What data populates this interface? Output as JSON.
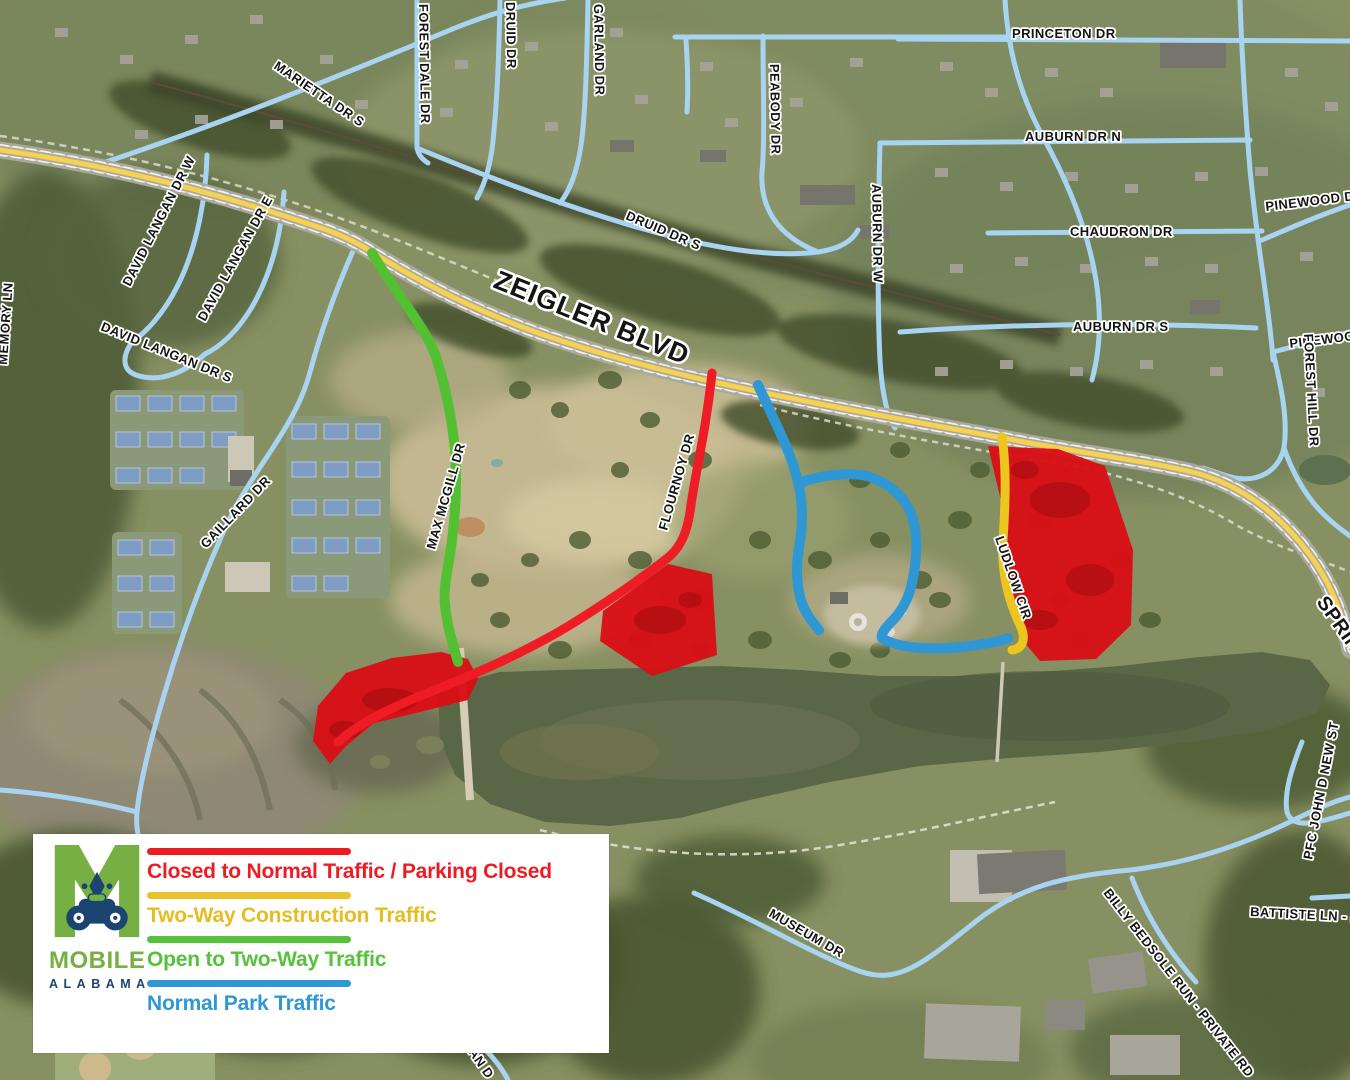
{
  "legend": {
    "logo": {
      "city": "MOBILE",
      "state": "ALABAMA"
    },
    "items": [
      {
        "label": "Closed to Normal Traffic / Parking Closed",
        "color": "#ED1C24"
      },
      {
        "label": "Two-Way Construction Traffic",
        "color": "#E9C32B"
      },
      {
        "label": "Open to Two-Way Traffic",
        "color": "#56C13C"
      },
      {
        "label": "Normal Park Traffic",
        "color": "#2E97D4"
      }
    ]
  },
  "map": {
    "labels": {
      "marietta": "MARIETTA DR S",
      "forest_dale": "FOREST DALE DR",
      "druid": "DRUID DR",
      "garland": "GARLAND DR",
      "peabody": "PEABODY DR",
      "auburn_w": "AUBURN DR W",
      "princeton": "PRINCETON DR",
      "auburn_n": "AUBURN DR N",
      "chaudron": "CHAUDRON DR",
      "auburn_s": "AUBURN DR S",
      "pinewood_n": "PINEWOOD DR",
      "pinewood_s": "PINEWOOD DR",
      "forest_hill": "FOREST HILL DR",
      "druid_s": "DRUID DR S",
      "zeigler": "ZEIGLER BLVD",
      "david_langan_w": "DAVID LANGAN DR W",
      "david_langan_e": "DAVID LANGAN DR E",
      "david_langan_s": "DAVID LANGAN DR S",
      "memory": "MEMORY LN",
      "max_mcgill": "MAX MCGILL DR",
      "flournoy": "FLOURNOY DR",
      "ludlow": "LUDLOW CIR",
      "gaillard": "GAILLARD DR",
      "museum": "MUSEUM DR",
      "billy_bedsole": "BILLY BEDSOLE RUN - PRIVATE RD",
      "battiste": "BATTISTE LN - PR",
      "pfc_john": "PFC JOHN D NEW ST",
      "spring": "SPRIN",
      "partial_s": "AN D"
    },
    "route_colors": {
      "closed": "#E51218",
      "construction": "#EFC31F",
      "open_two_way": "#56C13C",
      "normal_park": "#2E97D4"
    },
    "street_color": "#A8D4F2",
    "highway_color": "#F6D250"
  }
}
